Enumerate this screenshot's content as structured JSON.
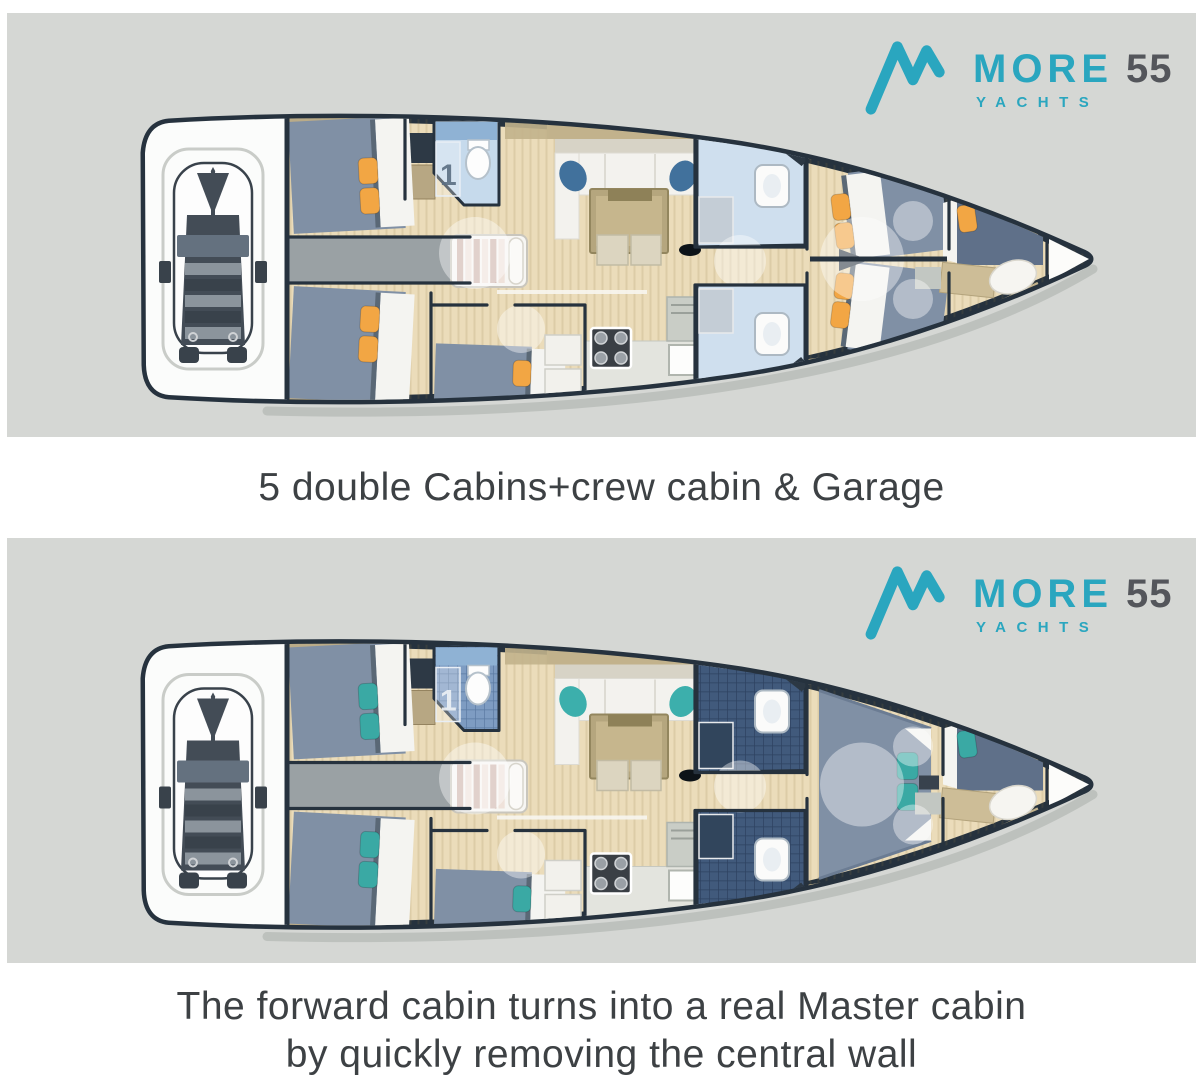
{
  "logo": {
    "brand": "MORE",
    "model": "55",
    "sub": "YACHTS",
    "teal": "#2aa6bf",
    "dark": "#54565b"
  },
  "captions": [
    {
      "lines": [
        "5 double Cabins+crew cabin & Garage"
      ]
    },
    {
      "lines": [
        "The forward cabin turns into a real Master cabin",
        "by quickly removing the central wall"
      ]
    }
  ],
  "head_label": "1",
  "panels": [
    {
      "id": "planA",
      "name": "five-double-cabins-plan",
      "pillow": "#f2a644",
      "chair": "#41719c",
      "bath": "light",
      "forward": "two-cabins"
    },
    {
      "id": "planB",
      "name": "master-cabin-plan",
      "pillow": "#3aa9a4",
      "chair": "#3cafac",
      "bath": "tiled",
      "forward": "master"
    }
  ],
  "palette": {
    "panel_bg": "#d5d7d4",
    "hull_outline": "#26323e",
    "floor": "#ebdcba",
    "wood_trim": "#c2b28c",
    "bed": "#8090a5",
    "bed_dark": "#5f7089",
    "mattress_white": "#f4f4f1",
    "garage_white": "#fbfcfb",
    "dinghy_dark": "#434c56",
    "dinghy_mid": "#8b949c",
    "bench": "#64717f",
    "corridor": "#9aa1a4",
    "stairs_light": "#efe2da",
    "stairs_pink": "#cdb2ab",
    "bath_light": "#c6daec",
    "bath_light2": "#cfdfee",
    "bath_counter": "#8fb2d4",
    "tile_med": "#7e9cc2",
    "tile_med_line": "#5b7aa2",
    "tile_dark": "#415a7c",
    "tile_dark_line": "#2d4160",
    "table": "#b5a67e",
    "settee": "#f3f2ee",
    "stove": "#3a3f45",
    "counter": "#e3e4de",
    "shadow": "#a9aeaa"
  }
}
